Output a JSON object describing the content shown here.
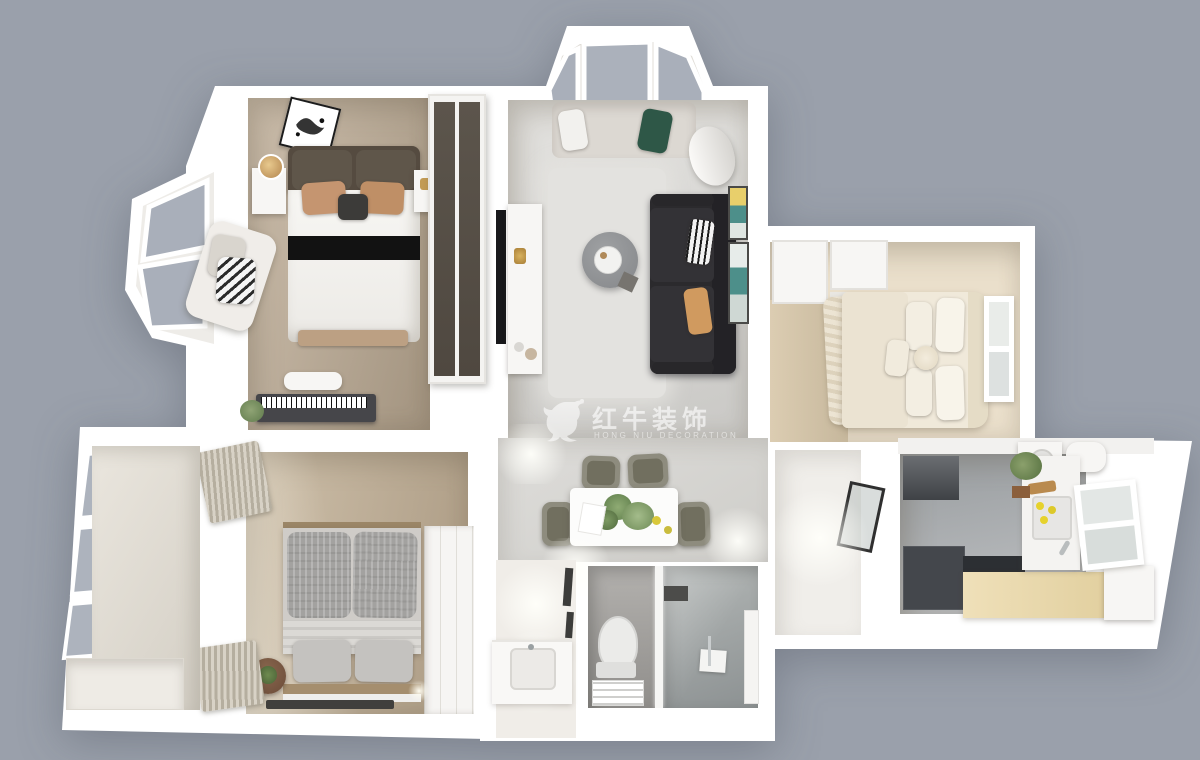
{
  "watermark": {
    "logo_icon": "bull-logo",
    "brand_cn": "红牛装饰",
    "brand_en": "HONG NIU DECORATION"
  },
  "palette": {
    "background": "#9aa0ab",
    "walls": "#ffffff",
    "master_floor_wood": "#bfae99",
    "living_floor": "#d8d7d4",
    "sofa_black": "#2b2a2d",
    "headboard_brown": "#554b40",
    "accent_pillow_tan": "#c59570",
    "accent_pillow_green": "#2e5747",
    "gray_bed": "#a3a2a0",
    "kitchen_floor": "#a6a9ac",
    "kitchen_counter_wood": "#e9d9b1",
    "bathroom_tile": "#a3a19e",
    "dining_chair_olive": "#8e8c7e",
    "window_glass": "#a9afba"
  },
  "scene": {
    "type": "3D apartment floor plan render, top-down view",
    "rooms": [
      "master bedroom",
      "living room",
      "top balcony",
      "right bedroom",
      "second bedroom",
      "left balcony",
      "dining area",
      "washbasin nook",
      "bathroom",
      "kitchen",
      "hallway"
    ]
  }
}
